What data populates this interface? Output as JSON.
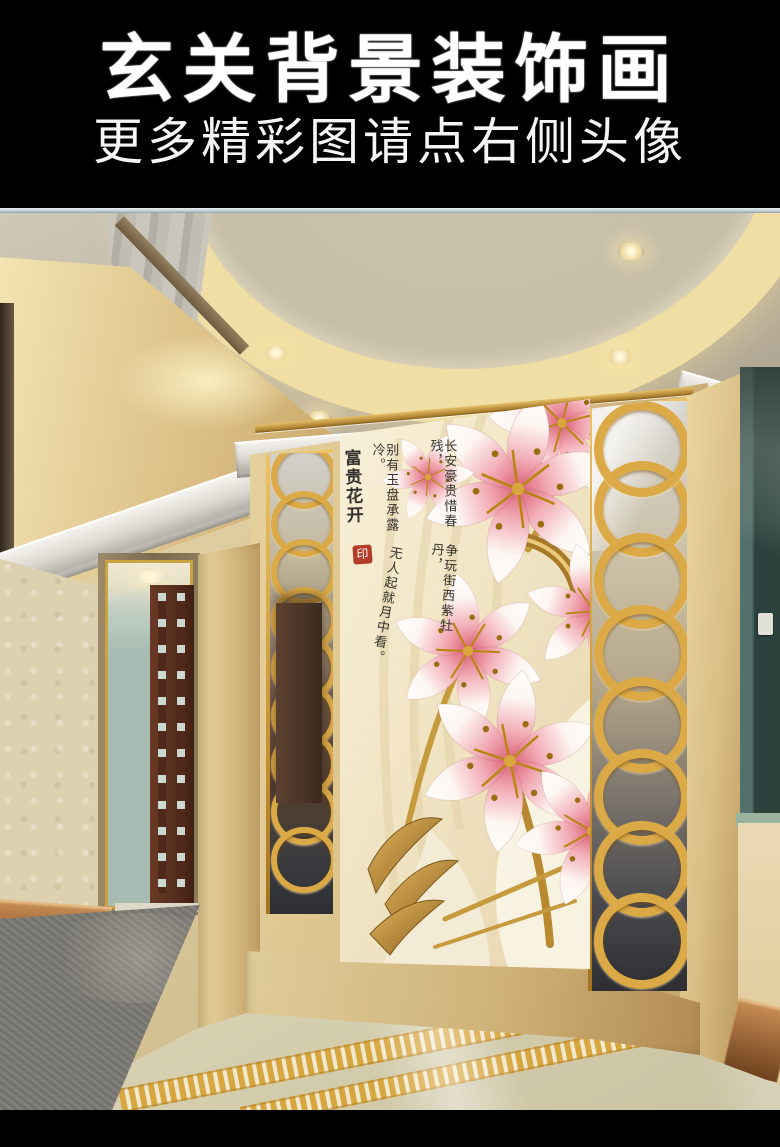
{
  "banner": {
    "title": "玄关背景装饰画",
    "subtitle": "更多精彩图请点右侧头像"
  },
  "scene": {
    "artwork": {
      "title": "富贵花开",
      "seal": "印",
      "poem_columns": [
        "长安豪贵惜春残，",
        "别有玉盘承露冷。",
        "争玩街西紫牡丹，",
        "无人起就月中看。"
      ]
    },
    "colors": {
      "banner_bg": "#000000",
      "banner_text": "#ffffff",
      "ceiling_a": "#b3aa98",
      "ceiling_b": "#cfc8b7",
      "ring_gold": "#f0dfa4",
      "marble_a": "#e6d19e",
      "marble_b": "#c2a267",
      "panel_gold": "#dca947",
      "art_a": "#f8f0da",
      "art_b": "#e7d5ae",
      "ink": "#35322c",
      "seal_red": "#b23c28",
      "wallpaper": "#ddd1b0",
      "skirt_a": "#a06a3c",
      "skirt_b": "#6e421d",
      "door_wood": "#572f1f",
      "room_teal": "#a7bcb2",
      "glass_a": "#54706a",
      "glass_b": "#2c423d",
      "carpet": "#7b7973",
      "floor_a": "#ece7cd",
      "floor_b": "#c9c3a2",
      "mosaic": "#d7a63f",
      "plinth_a": "#e0cc9a",
      "plinth_b": "#b08a50"
    }
  }
}
